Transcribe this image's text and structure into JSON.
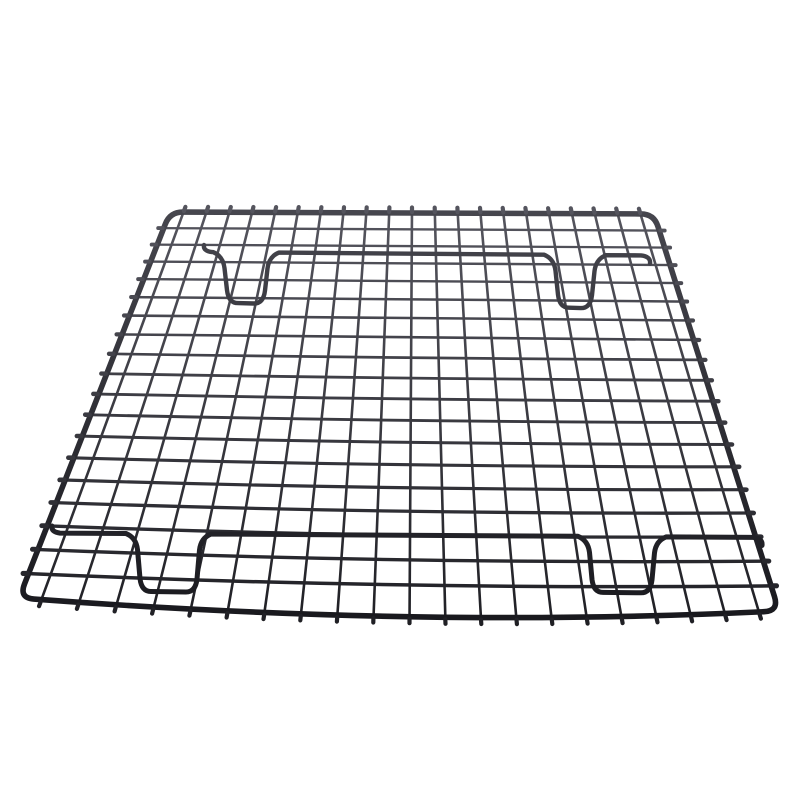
{
  "scene": {
    "description": "Perspective product photo of a black non-stick steel wire cooling rack (grid of welded wires) with two support leg bars and four U-shaped feet, isolated on a pure white background",
    "background": "#ffffff",
    "colors": {
      "wire_top": "#56565f",
      "wire_bottom": "#1e1e23",
      "frame_top": "#47474f",
      "frame_bottom": "#17171c"
    },
    "frame": {
      "corners": {
        "top_left": [
          170,
          212
        ],
        "top_right": [
          654,
          214
        ],
        "bottom_right": [
          779,
          611
        ],
        "bottom_left": [
          19,
          598
        ]
      },
      "bottom_sag_control": [
        420,
        628
      ],
      "corner_radius_top": 13,
      "corner_radius_bottom": 15,
      "stroke_width": 5.6
    },
    "grid": {
      "columns": 21,
      "col_start": 0.028,
      "col_end": 0.972,
      "rows": 18,
      "row_ease_linear": 0.78,
      "row_bow_max": 12,
      "v_stroke": 2.6,
      "h_stroke_top": 2.2,
      "h_stroke_bottom": 3.6,
      "nub_out_top": 5.5,
      "nub_out_bottom": 7,
      "nub_out_side": 5.5,
      "nub_extra_width": 1.6
    },
    "support_bars": [
      {
        "name": "rear-leg-bar",
        "start": [
          204,
          252
        ],
        "end": [
          650,
          255.5
        ],
        "stroke_width": 4.4,
        "feet": [
          {
            "x1": 222,
            "x2": 270,
            "depth": 51
          },
          {
            "x1": 553,
            "x2": 597,
            "depth": 53
          }
        ]
      },
      {
        "name": "front-leg-bar",
        "start": [
          52,
          533
        ],
        "end": [
          762,
          537.5
        ],
        "stroke_width": 5,
        "feet": [
          {
            "x1": 135,
            "x2": 202,
            "depth": 58
          },
          {
            "x1": 587,
            "x2": 657,
            "depth": 56
          }
        ]
      }
    ]
  }
}
